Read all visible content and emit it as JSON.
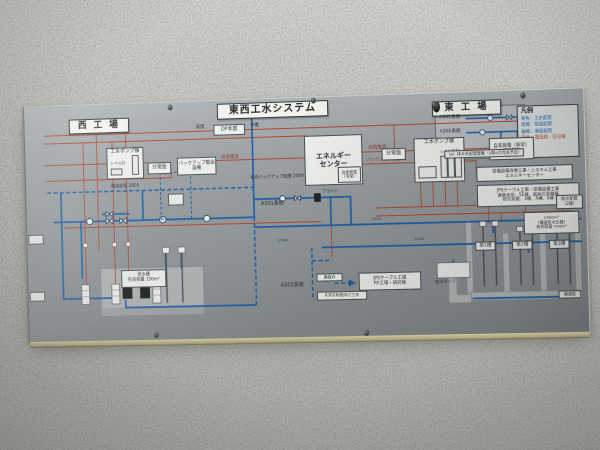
{
  "panel": {
    "titles": {
      "west": "西 工 場",
      "system": "東西工水システム",
      "east": "東 工 場"
    },
    "legend": {
      "title": "凡例",
      "items": [
        {
          "text": "青色：工水配管"
        },
        {
          "text": "実線：既設配管"
        },
        {
          "text": "破線：増設配管"
        },
        {
          "text": "赤色：電源線・信号線"
        }
      ]
    },
    "power": {
      "dp": "DP本部",
      "normal": "常用",
      "reserve": "予備",
      "commercial_west": "商用電源",
      "commercial_center": "商用電源",
      "backup_line": "バックアップ電源"
    },
    "west": {
      "pump_house": "工水ポンプ棟",
      "level_gauge": "レベル計",
      "switchboard": "分電盤",
      "backup_power": "バックアップ電源設備",
      "tank_note": "受水槽\n有効容量 150m³"
    },
    "center": {
      "energy_center": "エネルギー\nセンター",
      "self_generator": "自家発電\n（非常）",
      "switch_control": "自家発電（非常）\n切替制御",
      "backbone": "東西バックアップ配管 200A",
      "extension": "増設配管 200A",
      "a301": "A301系統",
      "a302": "A302系統",
      "flange": "フランジ",
      "connect_valve": "連絡弁",
      "a302_supply": "A302系統向け工水",
      "jps_note": "JPSケーブル工場\nRF工場・研究棟",
      "size_100": "100A",
      "size_150": "150A",
      "size_200": "200A"
    },
    "east": {
      "switchboard": "分電盤",
      "pump_house": "工水ポンプ棟",
      "level_gauge": "レベル計装",
      "detail": {
        "a301": "A301系統",
        "a302": "A302系統",
        "caption": "（A）排水系配管整備（2期4月完成予定）"
      },
      "tank_note": "1500m³\n（構造防水仕様）\n有効容量 450m³",
      "tanks": [
        "第1槽",
        "第2槽",
        "第3槽"
      ],
      "supply_pump": "給水ポンプ",
      "link_pipe": "連通管"
    },
    "notes": [
      {
        "text": "受電設備改善工事・システム工事\nエネルギーセンター"
      },
      {
        "text": "JPSケーブル工事・受電設備工事\n連携本部、5E棟、超高圧実験棟\n研究本館、3棟、4棟、6棟"
      },
      {
        "text": "給水配管\n（2棟）"
      }
    ]
  }
}
